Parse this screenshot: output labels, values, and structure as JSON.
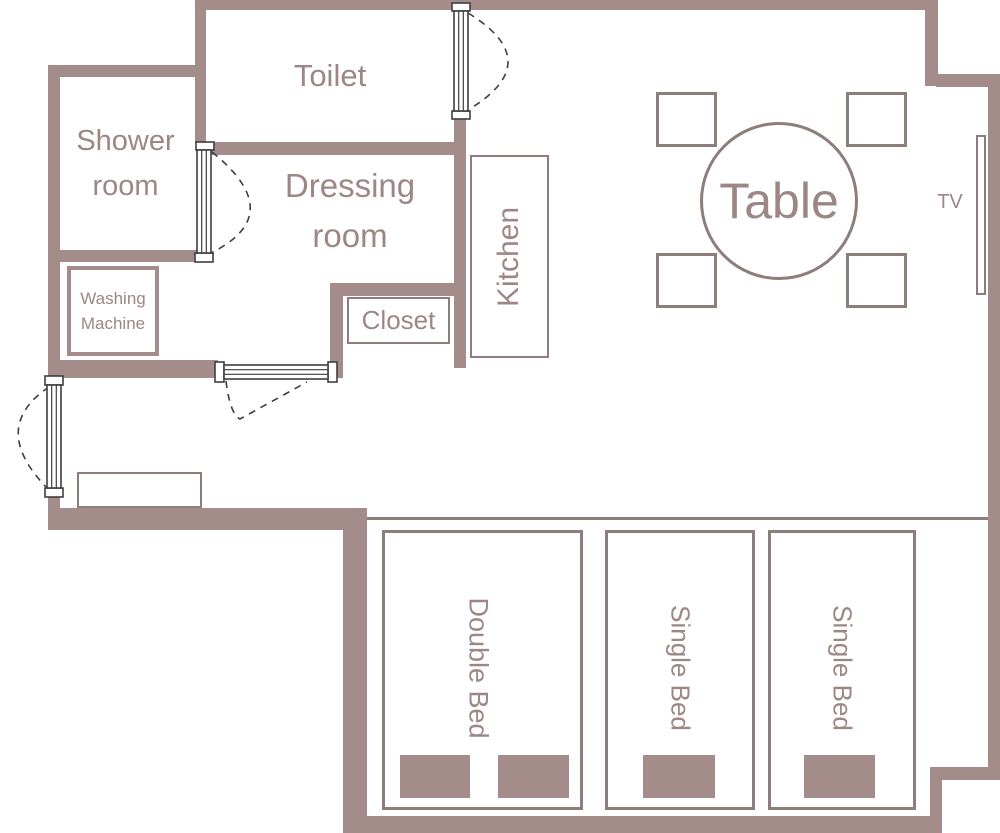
{
  "colors": {
    "wall": "#a48c8a",
    "furniture-border": "#8d7e7c",
    "label": "#9c8785",
    "door-line": "#3f3f3f"
  },
  "rooms": {
    "toilet": {
      "label": "Toilet"
    },
    "shower_room": {
      "line1": "Shower",
      "line2": "room"
    },
    "dressing_room": {
      "line1": "Dressing",
      "line2": "room"
    }
  },
  "fixtures": {
    "washing_machine": {
      "line1": "Washing",
      "line2": "Machine"
    },
    "closet": {
      "label": "Closet"
    },
    "kitchen": {
      "label": "Kitchen"
    },
    "table": {
      "label": "Table"
    },
    "tv": {
      "label": "TV"
    },
    "double_bed": {
      "label": "Double Bed"
    },
    "single_bed_left": {
      "label": "Single Bed"
    },
    "single_bed_right": {
      "label": "Single Bed"
    }
  }
}
